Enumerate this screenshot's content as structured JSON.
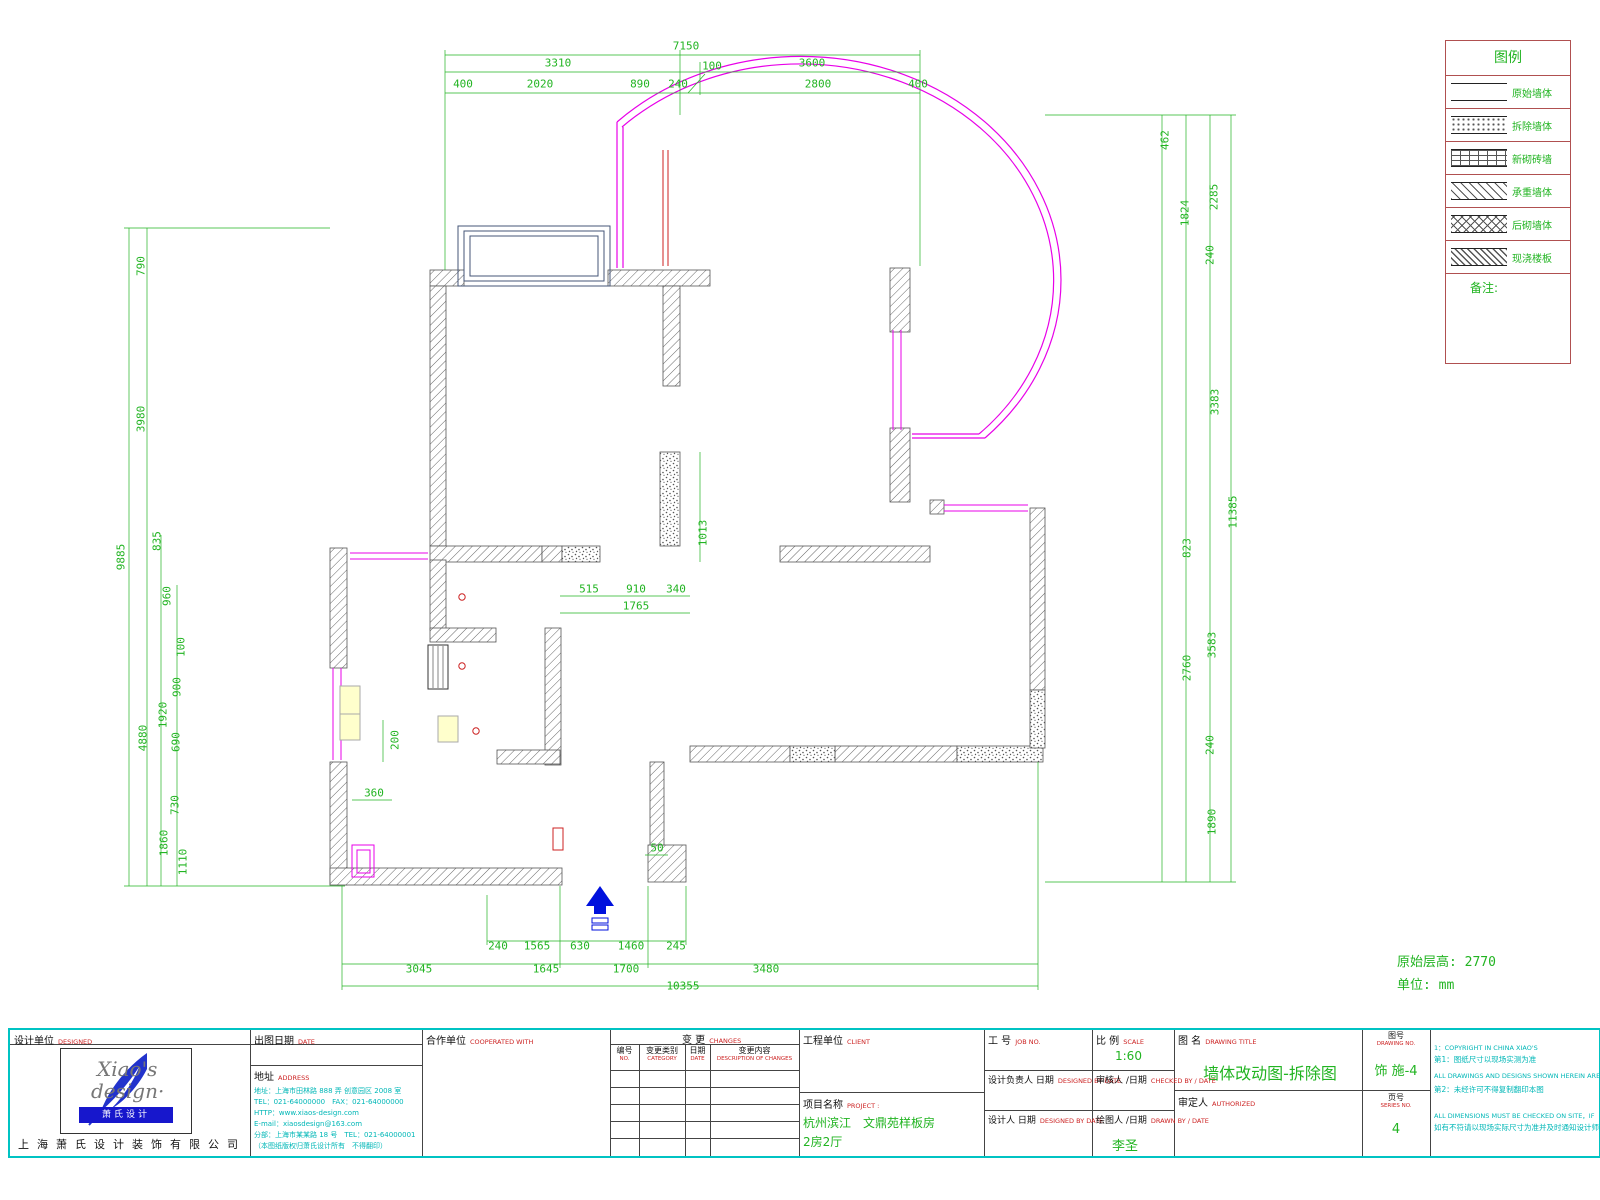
{
  "colors": {
    "dim_green": "#22b422",
    "magenta": "#e800e8",
    "cyan": "#00b7b7",
    "red": "#cc2222",
    "blue": "#0011dd",
    "wall_gray": "#555555",
    "legend_frame": "#b05050"
  },
  "legend": {
    "title": "图例",
    "note_label": "备注:",
    "items": [
      {
        "label": "原始墙体",
        "pattern": "plain"
      },
      {
        "label": "拆除墙体",
        "pattern": "stipple"
      },
      {
        "label": "新砌砖墙",
        "pattern": "brick"
      },
      {
        "label": "承重墙体",
        "pattern": "diagonal"
      },
      {
        "label": "后砌墙体",
        "pattern": "crosshatch"
      },
      {
        "label": "现浇楼板",
        "pattern": "dense-diagonal"
      }
    ]
  },
  "plan": {
    "notes": {
      "floor_height": "原始层高: 2770",
      "unit": "单位: mm"
    },
    "dims": {
      "top_total": "7150",
      "top_a": [
        "3310",
        "100",
        "3600"
      ],
      "top_b": [
        "400",
        "2020",
        "890",
        "240",
        "2800",
        "400"
      ],
      "left": [
        "790",
        "3980",
        "9885",
        "835",
        "960",
        "100",
        "900",
        "1920",
        "690",
        "4880",
        "730",
        "1860",
        "1110"
      ],
      "right": [
        "462",
        "1824",
        "2285",
        "240",
        "3383",
        "11385",
        "823",
        "3583",
        "2760",
        "240",
        "1890"
      ],
      "bottom_a": [
        "240",
        "1565",
        "630",
        "1460",
        "245"
      ],
      "bottom_b": [
        "3045",
        "1645",
        "1700",
        "3480"
      ],
      "bottom_total": "10355",
      "inner": [
        "515",
        "910",
        "340",
        "1765",
        "1013",
        "200",
        "360",
        "50"
      ]
    }
  },
  "titleblock": {
    "designer": {
      "zh": "设计单位",
      "en": "DESIGNED"
    },
    "logo": {
      "name1": "Xiao's",
      "name2": "design·",
      "banner": "萧氏设计",
      "company": "上海萧氏设计装饰有限公司"
    },
    "date": {
      "zh": "出图日期",
      "en": "DATE"
    },
    "address": {
      "zh": "地址",
      "en": "ADDRESS",
      "lines": [
        "地址：上海市田林路 888 弄 创意园区 2008 室",
        "TEL：021-64000000　FAX：021-64000000",
        "HTTP：www.xiaos-design.com",
        "E-mail：xiaosdesign@163.com",
        "分部：上海市某某路 18 号　TEL：021-64000001",
        "（本图纸版权归萧氏设计所有　不得翻印）"
      ]
    },
    "coop": {
      "zh": "合作单位",
      "en": "COOPERATED WITH"
    },
    "changes": {
      "zh": "变 更",
      "en": "CHANGES",
      "cols": [
        {
          "zh": "编号",
          "en": "NO."
        },
        {
          "zh": "变更类别",
          "en": "CATEGORY"
        },
        {
          "zh": "日期",
          "en": "DATE"
        },
        {
          "zh": "变更内容",
          "en": "DESCRIPTION OF CHANGES"
        }
      ]
    },
    "client": {
      "zh": "工程单位",
      "en": "CLIENT"
    },
    "project": {
      "zh": "项目名称",
      "en": "PROJECT :",
      "line1": "杭州滨江　文鼎苑样板房",
      "line2": "2房2厅"
    },
    "job": {
      "zh": "工 号",
      "en": "JOB NO."
    },
    "scale": {
      "zh": "比 例",
      "en": "SCALE",
      "value": "1:60"
    },
    "lead": {
      "zh": "设计负责人 日期",
      "en": "DESIGNED BY DATE"
    },
    "checked": {
      "zh": "审核人 /日期",
      "en": "CHECKED BY / DATE"
    },
    "designed": {
      "zh": "设计人 日期",
      "en": "DESIGNED BY DATE"
    },
    "drawn": {
      "zh": "绘图人 /日期",
      "en": "DRAWN BY / DATE",
      "value": "李圣"
    },
    "title": {
      "zh": "图 名",
      "en": "DRAWING TITLE",
      "value": "墙体改动图-拆除图"
    },
    "number": {
      "zh": "图号",
      "en": "DRAWING NO.",
      "value": "饰 施-4"
    },
    "auth": {
      "zh": "审定人",
      "en": "AUTHORIZED"
    },
    "series": {
      "zh": "页号",
      "en": "SERIES NO.",
      "value": "4"
    },
    "notes": [
      "1：COPYRIGHT IN CHINA XIAO'S",
      "第1：图纸尺寸以现场实测为准",
      "ALL DRAWINGS AND DESIGNS SHOWN HEREIN ARE PROPERTY",
      "第2：未经许可不得复制翻印本图",
      "ALL DIMENSIONS MUST BE CHECKED ON SITE，IF",
      "如有不符请以现场实际尺寸为准并及时通知设计师"
    ]
  }
}
